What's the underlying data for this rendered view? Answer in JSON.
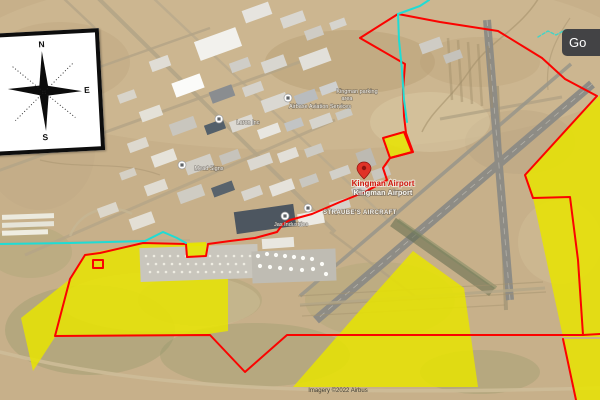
{
  "map": {
    "google_watermark": "Go",
    "attribution": "Imagery ©2022 Airbus",
    "compass": {
      "n": "N",
      "e": "E",
      "s": "S"
    },
    "colors": {
      "zone_fill": "#e7e400",
      "boundary": "#fb0300",
      "utility": "#1fdcd4",
      "airport_label_red": "#cf1a10",
      "label_white": "#f4f2ec"
    },
    "zones": [
      {
        "name": "southwest-parcel",
        "layer": "under",
        "points": "85,254 143,243 205,244 240,251 241,259 228,262 228,331 208,334 55,337 33,371 21,318 70,279"
      },
      {
        "name": "south-triangle-parcel",
        "layer": "under",
        "points": "413,251 464,288 478,387 293,387 355,316"
      },
      {
        "name": "east-chevron-parcel",
        "layer": "under",
        "points": "600,95 525,174 533,198 563,337 600,337"
      },
      {
        "name": "southeast-corner-parcel",
        "layer": "under",
        "points": "563,339 600,339 600,400 575,400"
      },
      {
        "name": "midfield-small-parcel",
        "layer": "under",
        "points": "383,138 404,132 412,152 390,158"
      },
      {
        "name": "ramp-small-parcel",
        "layer": "over",
        "points": "186,243 206,242 207,256 187,257"
      }
    ],
    "boundary_paths": [
      "M398,14 L360,38 L405,64 L403,90 L404,116 L406,133 L413,152 L390,158 L383,168 L387,180 L365,192 L340,202 L312,214 L290,220 L283,224 L277,232 L255,238 L230,241 L208,244 L206,256 L187,257 L186,244 L143,243 L100,253 L85,255 L70,279 L55,336 L210,335 L245,372 L287,335 L583,335 L600,334",
      "M398,14 L440,22 L498,31 L542,58 L565,79 L597,96 L525,175 L533,198 L570,197 L578,260 L583,335",
      "M383,138 L404,132 L412,152 L390,158 Z",
      "M93,260 L103,260 L103,268 L93,268 Z",
      "M563,339 L576,400"
    ],
    "utility_paths": [
      {
        "d": "M0,244 L70,243 L145,241 L163,232 L177,238 L186,243",
        "dash": ""
      },
      {
        "d": "M429,0 L420,6 L398,14 L399,40 L402,70 L404,100 L407,122",
        "dash": ""
      },
      {
        "d": "M538,37 L548,31 L556,35 L565,30 L572,33",
        "dash": "3 2"
      }
    ],
    "pins": [
      {
        "type": "airport",
        "x": 364,
        "y": 170
      },
      {
        "type": "poi",
        "x": 285,
        "y": 216
      },
      {
        "type": "poi",
        "x": 308,
        "y": 208
      },
      {
        "type": "poi",
        "x": 219,
        "y": 119
      },
      {
        "type": "poi",
        "x": 182,
        "y": 165
      },
      {
        "type": "poi",
        "x": 288,
        "y": 98
      }
    ],
    "labels": [
      {
        "text": "Kingman Airport",
        "x": 383,
        "y": 186,
        "size": 8,
        "color": "#cf1a10",
        "weight": "bold",
        "halo": "#ffffff",
        "haloW": 2
      },
      {
        "text": "Kingman Airport",
        "x": 383,
        "y": 195,
        "size": 7.5,
        "color": "#f7f5ef",
        "weight": "bold",
        "halo": "#55504a",
        "haloW": 1.6
      },
      {
        "text": "STRAUBE'S AIRCRAFT",
        "x": 360,
        "y": 214,
        "size": 6,
        "color": "#f2f0ea",
        "weight": "bold",
        "halo": "#55504a",
        "haloW": 1.3,
        "spacing": 0.4
      },
      {
        "text": "Jas Industries",
        "x": 291,
        "y": 226,
        "size": 5.5,
        "color": "#f2f0ea",
        "halo": "#55504a",
        "haloW": 1.2
      },
      {
        "text": "Laron Inc",
        "x": 248,
        "y": 124,
        "size": 5.5,
        "color": "#f2f0ea",
        "halo": "#55504a",
        "haloW": 1.2
      },
      {
        "text": "Mead Signs",
        "x": 209,
        "y": 170,
        "size": 5.5,
        "color": "#f2f0ea",
        "halo": "#55504a",
        "haloW": 1.2
      },
      {
        "text": "Airbase Aviation Services",
        "x": 320,
        "y": 108,
        "size": 5.5,
        "color": "#f2f0ea",
        "halo": "#55504a",
        "haloW": 1.2
      },
      {
        "text": "Kingman parking",
        "x": 357,
        "y": 93,
        "size": 5.5,
        "color": "#f2f0ea",
        "halo": "#55504a",
        "haloW": 1.2
      },
      {
        "text": "area",
        "x": 347,
        "y": 100,
        "size": 5.5,
        "color": "#f2f0ea",
        "halo": "#55504a",
        "haloW": 1.2
      },
      {
        "text": "Imagery ©2022 Airbus",
        "x": 338,
        "y": 392,
        "size": 6,
        "color": "#3f3a30"
      }
    ]
  }
}
